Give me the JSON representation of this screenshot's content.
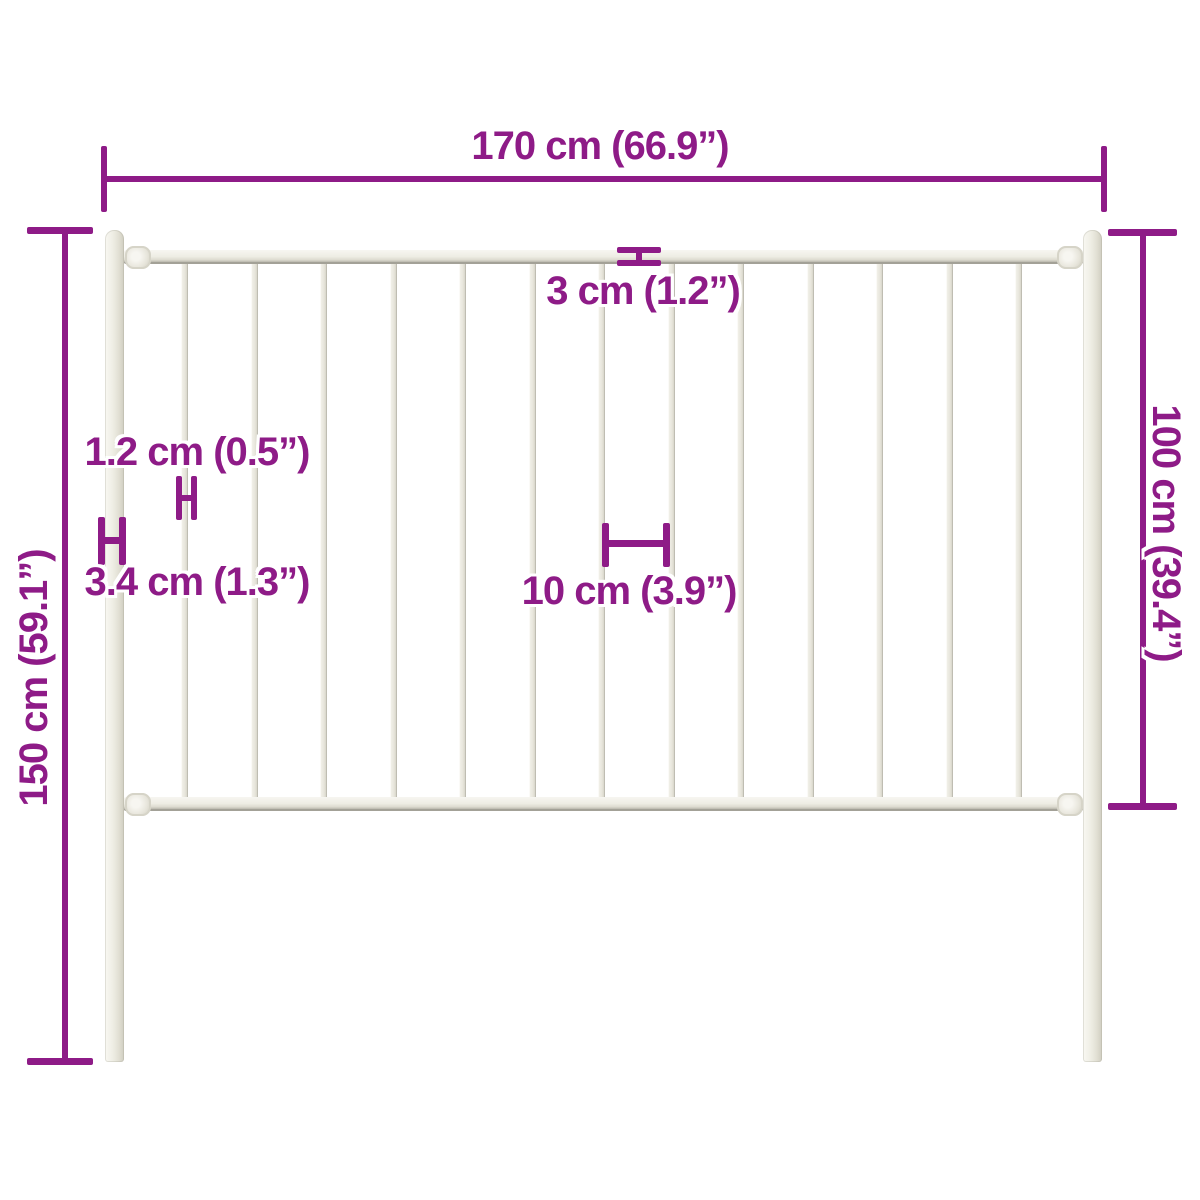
{
  "diagram": {
    "type": "product-dimension-diagram",
    "subject": "fence-panel-with-posts",
    "accent_color": "#8e1b87",
    "fence_color": "#efede5",
    "background_color": "#ffffff",
    "fence": {
      "bars_count": 13,
      "posts_count": 2,
      "rails_count": 2
    },
    "labels": {
      "total_width": "170 cm (66.9”)",
      "panel_height": "100 cm (39.4”)",
      "post_height": "150 cm (59.1”)",
      "rail_thickness": "3 cm (1.2”)",
      "bar_thickness": "1.2 cm (0.5”)",
      "post_thickness": "3.4 cm (1.3”)",
      "bar_spacing": "10 cm (3.9”)"
    }
  }
}
